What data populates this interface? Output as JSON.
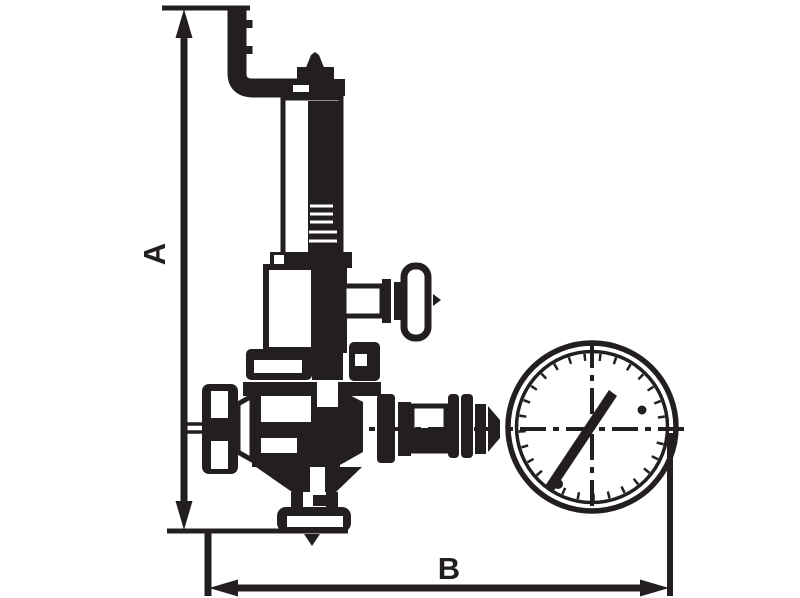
{
  "drawing": {
    "ink_color": "#231f20",
    "background_color": "#ffffff",
    "dimension_labels": {
      "overall_height": "A",
      "overall_width": "B"
    },
    "components": [
      "bent-lever-rod",
      "stem-cap",
      "bonnet-tube",
      "threaded-spindle",
      "spring-housing",
      "side-handle",
      "body-flange",
      "valve-body",
      "inlet-union-flange",
      "bottom-outlet-union",
      "flow-direction-arrow",
      "gauge-piping",
      "pressure-gauge",
      "gauge-needle"
    ]
  }
}
